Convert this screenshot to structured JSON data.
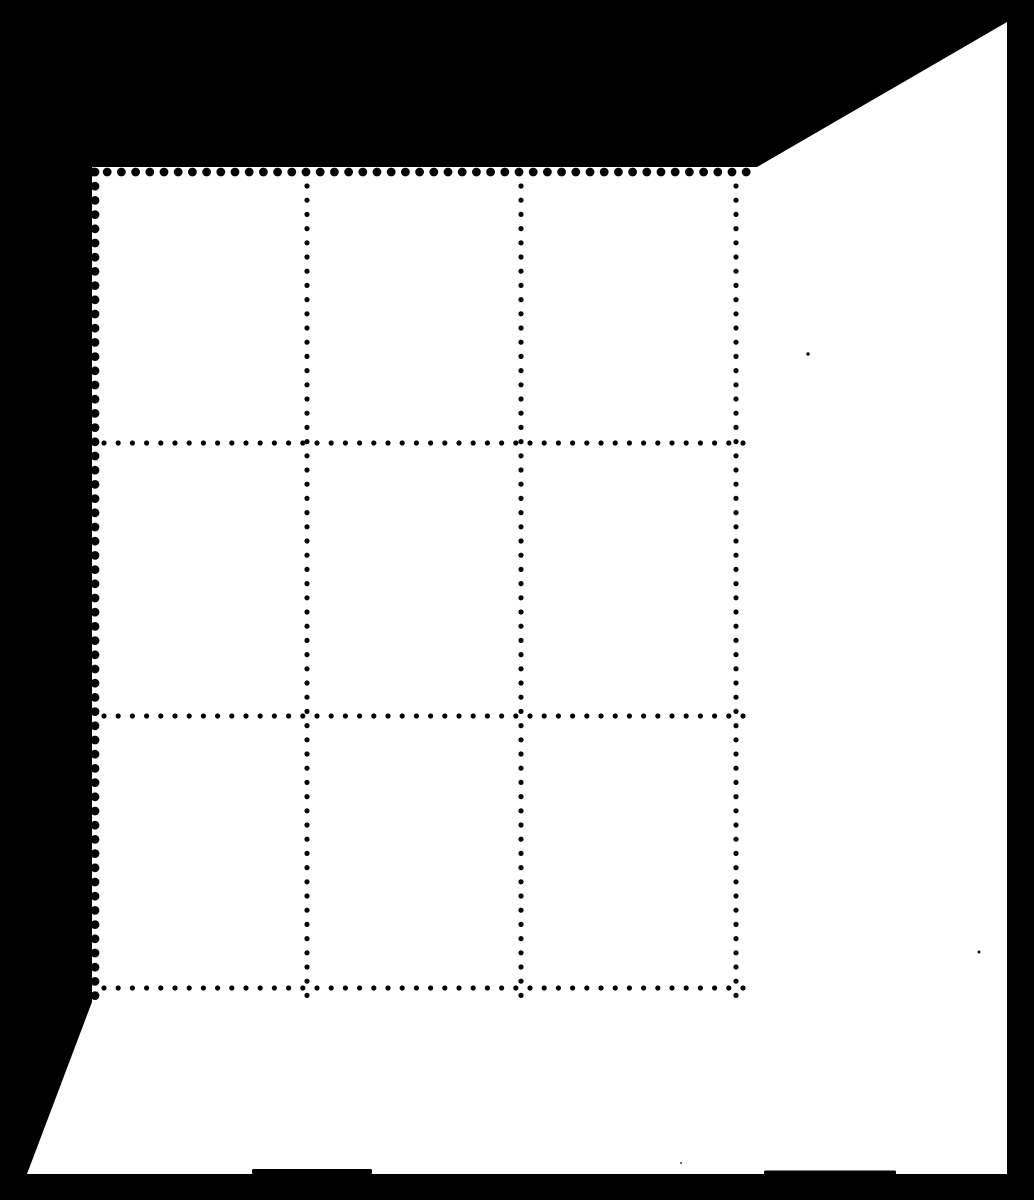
{
  "scene": {
    "canvas": {
      "width": 1034,
      "height": 1200
    },
    "background_color": "#000000",
    "sheet_color": "#ffffff",
    "description": "Black-background scan of a blank corner block of nine perforated stamps (3 x 3) with wide selvage margins at right and bottom"
  },
  "sheet": {
    "outline": [
      [
        92,
        167
      ],
      [
        757,
        167
      ],
      [
        1007,
        22
      ],
      [
        1007,
        1174
      ],
      [
        27,
        1174
      ],
      [
        92,
        1002
      ]
    ],
    "edge_smudges": [
      {
        "x": 252,
        "y": 1169,
        "w": 120,
        "h": 5,
        "color": "#000000"
      },
      {
        "x": 764,
        "y": 1170.5,
        "w": 132,
        "h": 4,
        "color": "#000000"
      }
    ]
  },
  "perforations": {
    "color": "#060606",
    "dot_pitch": 14.2,
    "interior_dot_radius": 2.6,
    "edge_notch_radius": 4.4,
    "edge_rows": [
      {
        "edge": "top",
        "x1": 93,
        "y1": 172,
        "x2": 757,
        "y2": 172
      },
      {
        "edge": "left",
        "x1": 95,
        "y1": 172,
        "x2": 95,
        "y2": 1001
      }
    ],
    "vertical_lines": [
      {
        "x": 307,
        "y1": 186,
        "y2": 1001
      },
      {
        "x": 521,
        "y1": 186,
        "y2": 1001
      },
      {
        "x": 736,
        "y1": 186,
        "y2": 1001
      }
    ],
    "horizontal_lines": [
      {
        "y": 443,
        "x1": 104,
        "x2": 750
      },
      {
        "y": 716,
        "x1": 104,
        "x2": 750
      },
      {
        "y": 988,
        "x1": 104,
        "x2": 750
      }
    ]
  },
  "stamp_grid": {
    "rows": 3,
    "columns": 3,
    "blank_stamps": 9
  },
  "specks": [
    {
      "x": 808,
      "y": 354,
      "r": 1.7,
      "color": "#101010"
    },
    {
      "x": 979,
      "y": 952,
      "r": 1.5,
      "color": "#1a1a1a"
    },
    {
      "x": 681,
      "y": 1163,
      "r": 1.1,
      "color": "#5a5a5a"
    }
  ]
}
